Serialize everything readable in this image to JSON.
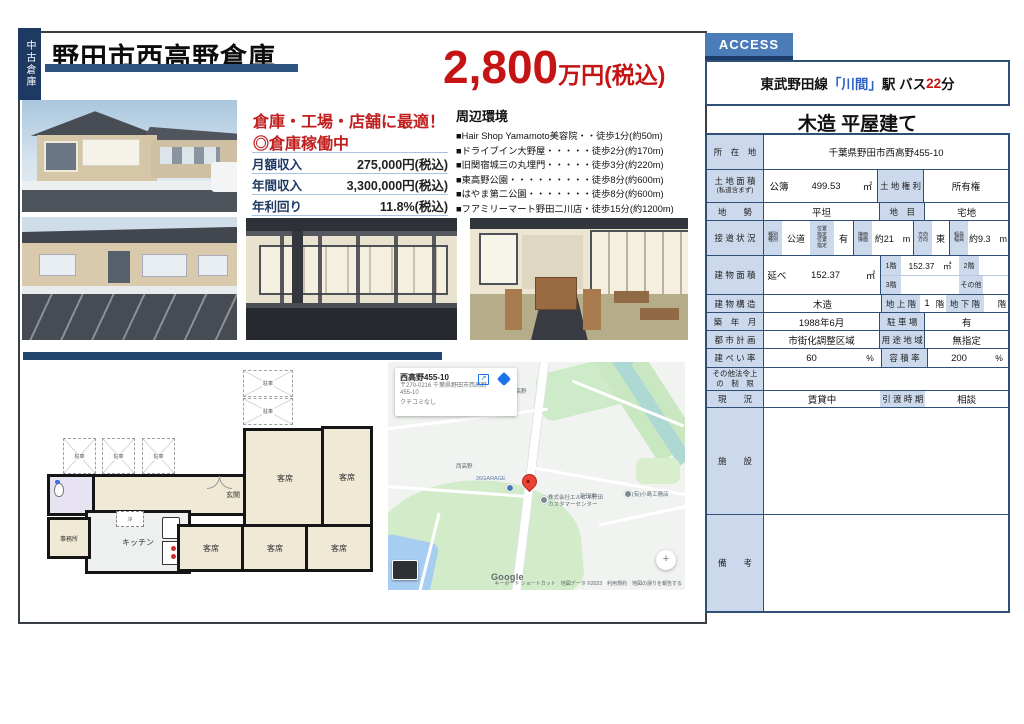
{
  "colors": {
    "navy": "#1e3a63",
    "steel_blue": "#2e5582",
    "red": "#c41414",
    "table_header_bg": "#ccd9ec",
    "access_blue": "#4c7cb8",
    "station_blue": "#2d62c4"
  },
  "badge": {
    "vertical_label": "中古倉庫"
  },
  "header": {
    "title": "野田市西高野倉庫",
    "price_amount": "2,800",
    "price_unit": "万円(税込)"
  },
  "highlights": {
    "line1": "倉庫・工場・店舗に最適！",
    "line2": "◎倉庫稼働中",
    "income": [
      {
        "label": "月額収入",
        "value": "275,000円(税込)"
      },
      {
        "label": "年間収入",
        "value": "3,300,000円(税込)"
      },
      {
        "label": "年利回り",
        "value": "11.8%(税込)"
      }
    ]
  },
  "surroundings": {
    "title": "周辺環境",
    "items": [
      "■Hair Shop Yamamoto美容院・・徒歩1分(約50m)",
      "■ドライブイン大野屋・・・・・徒歩2分(約170m)",
      "■旧関宿城三の丸埋門・・・・・徒歩3分(約220m)",
      "■東高野公園・・・・・・・・・徒歩8分(約600m)",
      "■はやま第二公園・・・・・・・徒歩8分(約600m)",
      "■フアミリーマート野田二川店・徒歩15分(約1200m)"
    ]
  },
  "access": {
    "tab": "ACCESS",
    "line_name": "東武野田線",
    "station": "「川間」",
    "after_station": "駅 バス",
    "minutes": "22",
    "minutes_unit": "分"
  },
  "building_headline": "木造 平屋建て",
  "property": {
    "location_label": "所　在　地",
    "location": "千葉県野田市西高野455-10",
    "land_area_label": "土 地 面 積",
    "land_area_label2": "(私道含まず)",
    "land_area_kobo": "公簿",
    "land_area_value": "499.53",
    "land_area_unit": "㎡",
    "land_right_label": "土 地 権 利",
    "land_right": "所有権",
    "terrain_label": "地　　勢",
    "terrain": "平坦",
    "landcat_label": "地　目",
    "landcat": "宅地",
    "road_label": "接 道 状 況",
    "road": {
      "type_label": "種別\n種別",
      "type": "公道",
      "pos_label": "位置\n指定\n位置\n指定",
      "pos": "有",
      "face_label": "接面\n接面",
      "face": "約21　m",
      "dir_label": "方向\n方向",
      "dir": "東",
      "width_label": "幅員\n幅員",
      "width": "約9.3　m"
    },
    "barea_label": "建 物 面 積",
    "barea_nobe": "延べ",
    "barea_value": "152.37",
    "barea_unit": "㎡",
    "f1_label": "1階",
    "f1_value": "152.37　㎡",
    "f2_label": "2階",
    "f2_value": "",
    "f3_label": "3階",
    "f3_value": "",
    "fother_label": "その他",
    "fother_value": "",
    "structure_label": "建 物 構 造",
    "structure": "木造",
    "above_label": "地 上 階",
    "above": "1",
    "above_unit": "階",
    "below_label": "地 下 階",
    "below": "",
    "below_unit": "階",
    "built_label": "築　年　月",
    "built": "1988年6月",
    "parking_label": "駐 車 場",
    "parking": "有",
    "cityplan_label": "都 市 計 画",
    "cityplan": "市街化調整区域",
    "usezone_label": "用 途 地 域",
    "usezone": "無指定",
    "bcr_label": "建 ぺ い 率",
    "bcr": "60",
    "bcr_unit": "%",
    "far_label": "容 積 率",
    "far": "200",
    "far_unit": "%",
    "otherlaw_label": "その他法令上\nの　制　限",
    "otherlaw": "",
    "status_label": "現　　況",
    "status": "賃貸中",
    "handover_label": "引 渡 時 期",
    "handover": "相談",
    "facility_label": "施　　設",
    "facility": "",
    "remarks_label": "備　　考",
    "remarks": ""
  },
  "floorplan": {
    "parking": "駐車",
    "entrance": "玄関",
    "seat": "客席",
    "kitchen": "キッチン",
    "office": "事務所",
    "fridge": "冷"
  },
  "map": {
    "card": {
      "title": "西高野455-10",
      "address1": "〒270-0216 千葉県野田市西高野",
      "address2": "455-10",
      "reviews": "クチコミなし"
    },
    "labels": {
      "higashi": "東高野",
      "nishi": "西高野",
      "drivein": "ドライブイン大野屋",
      "garage": "26GARAGE",
      "nitado": "新田戸",
      "kojima": "(有)小島工務店",
      "elpio1": "株式会社エルピオ野田",
      "elpio2": "カスタマーセンター"
    },
    "google": "Google",
    "attribution": "キーボード ショートカット　地図データ ©2023　利用規約　地図の誤りを報告する"
  }
}
